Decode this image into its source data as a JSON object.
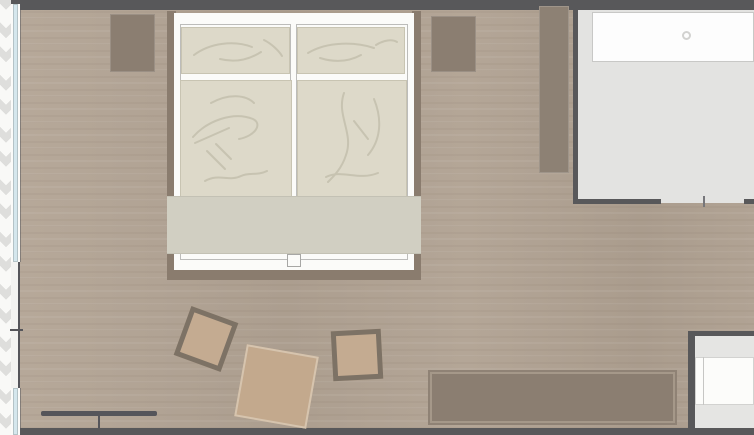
{
  "app": {
    "type": "floor-plan-render",
    "description": "Top-down architectural plan of a hotel bedroom with double bed, nightstands, wardrobe, floor cushions, sideboard, window wall with curtain, and adjoining bathroom/vestibule with vanity"
  },
  "palette": {
    "wall": "#58585a",
    "wood_floor": "#b0a293",
    "wood_floor_light": "#b7a99a",
    "wood_floor_dark": "#aa9c8d",
    "curtain_white": "#f9f9f7",
    "curtain_gray": "#dededc",
    "window_glass": "#d5e7ed",
    "furniture_taupe": "#8b7e71",
    "bed_rail_brown": "#8a7c6e",
    "mattress_white": "#fbfbf9",
    "bedding_beige": "#ddd9c9",
    "bedding_crease": "#c7c3b1",
    "blanket_sage": "#d1cfc2",
    "cushion_tan": "#c4ab91",
    "cushion_frame": "#7d7265",
    "gray_room_floor": "#e3e3e1",
    "counter_white": "#fdfdfd",
    "counter_border": "#c8c8c6"
  },
  "objects": {
    "bedroom": {
      "bed": {
        "parts": [
          "left-rail",
          "right-rail",
          "foot-rail",
          "mattress-left",
          "mattress-right",
          "pillow-left",
          "pillow-right",
          "duvet-left",
          "duvet-right",
          "bed-runner-blanket",
          "mattress-split-notch"
        ]
      },
      "nightstands": [
        "nightstand-left",
        "nightstand-right"
      ],
      "wardrobe": "tall-wardrobe-right-of-bed",
      "floor_cushions": [
        "framed-cushion-left",
        "large-plain-cushion-center",
        "framed-cushion-right"
      ],
      "sideboard": "low-sideboard-bottom-wall",
      "window_wall": [
        "curtain-zigzag-strip",
        "window-pane-1",
        "wall-pier",
        "pier-tick",
        "window-pane-2"
      ],
      "door_marker": [
        "slidedoor-bar",
        "slidedoor-stem"
      ]
    },
    "adjoining_room": {
      "floor": "light-gray-tile",
      "vanity": {
        "counter": "white-countertop",
        "basin_icon": "small-circle-drain"
      },
      "door_opening": {
        "wall_segments": 2,
        "jamb_tick": 1
      }
    },
    "entry_area": [
      "entry-wall-left",
      "entry-wall-top",
      "threshold-strip-top",
      "door-leaf",
      "door-edge-line",
      "threshold-strip-bottom"
    ]
  }
}
